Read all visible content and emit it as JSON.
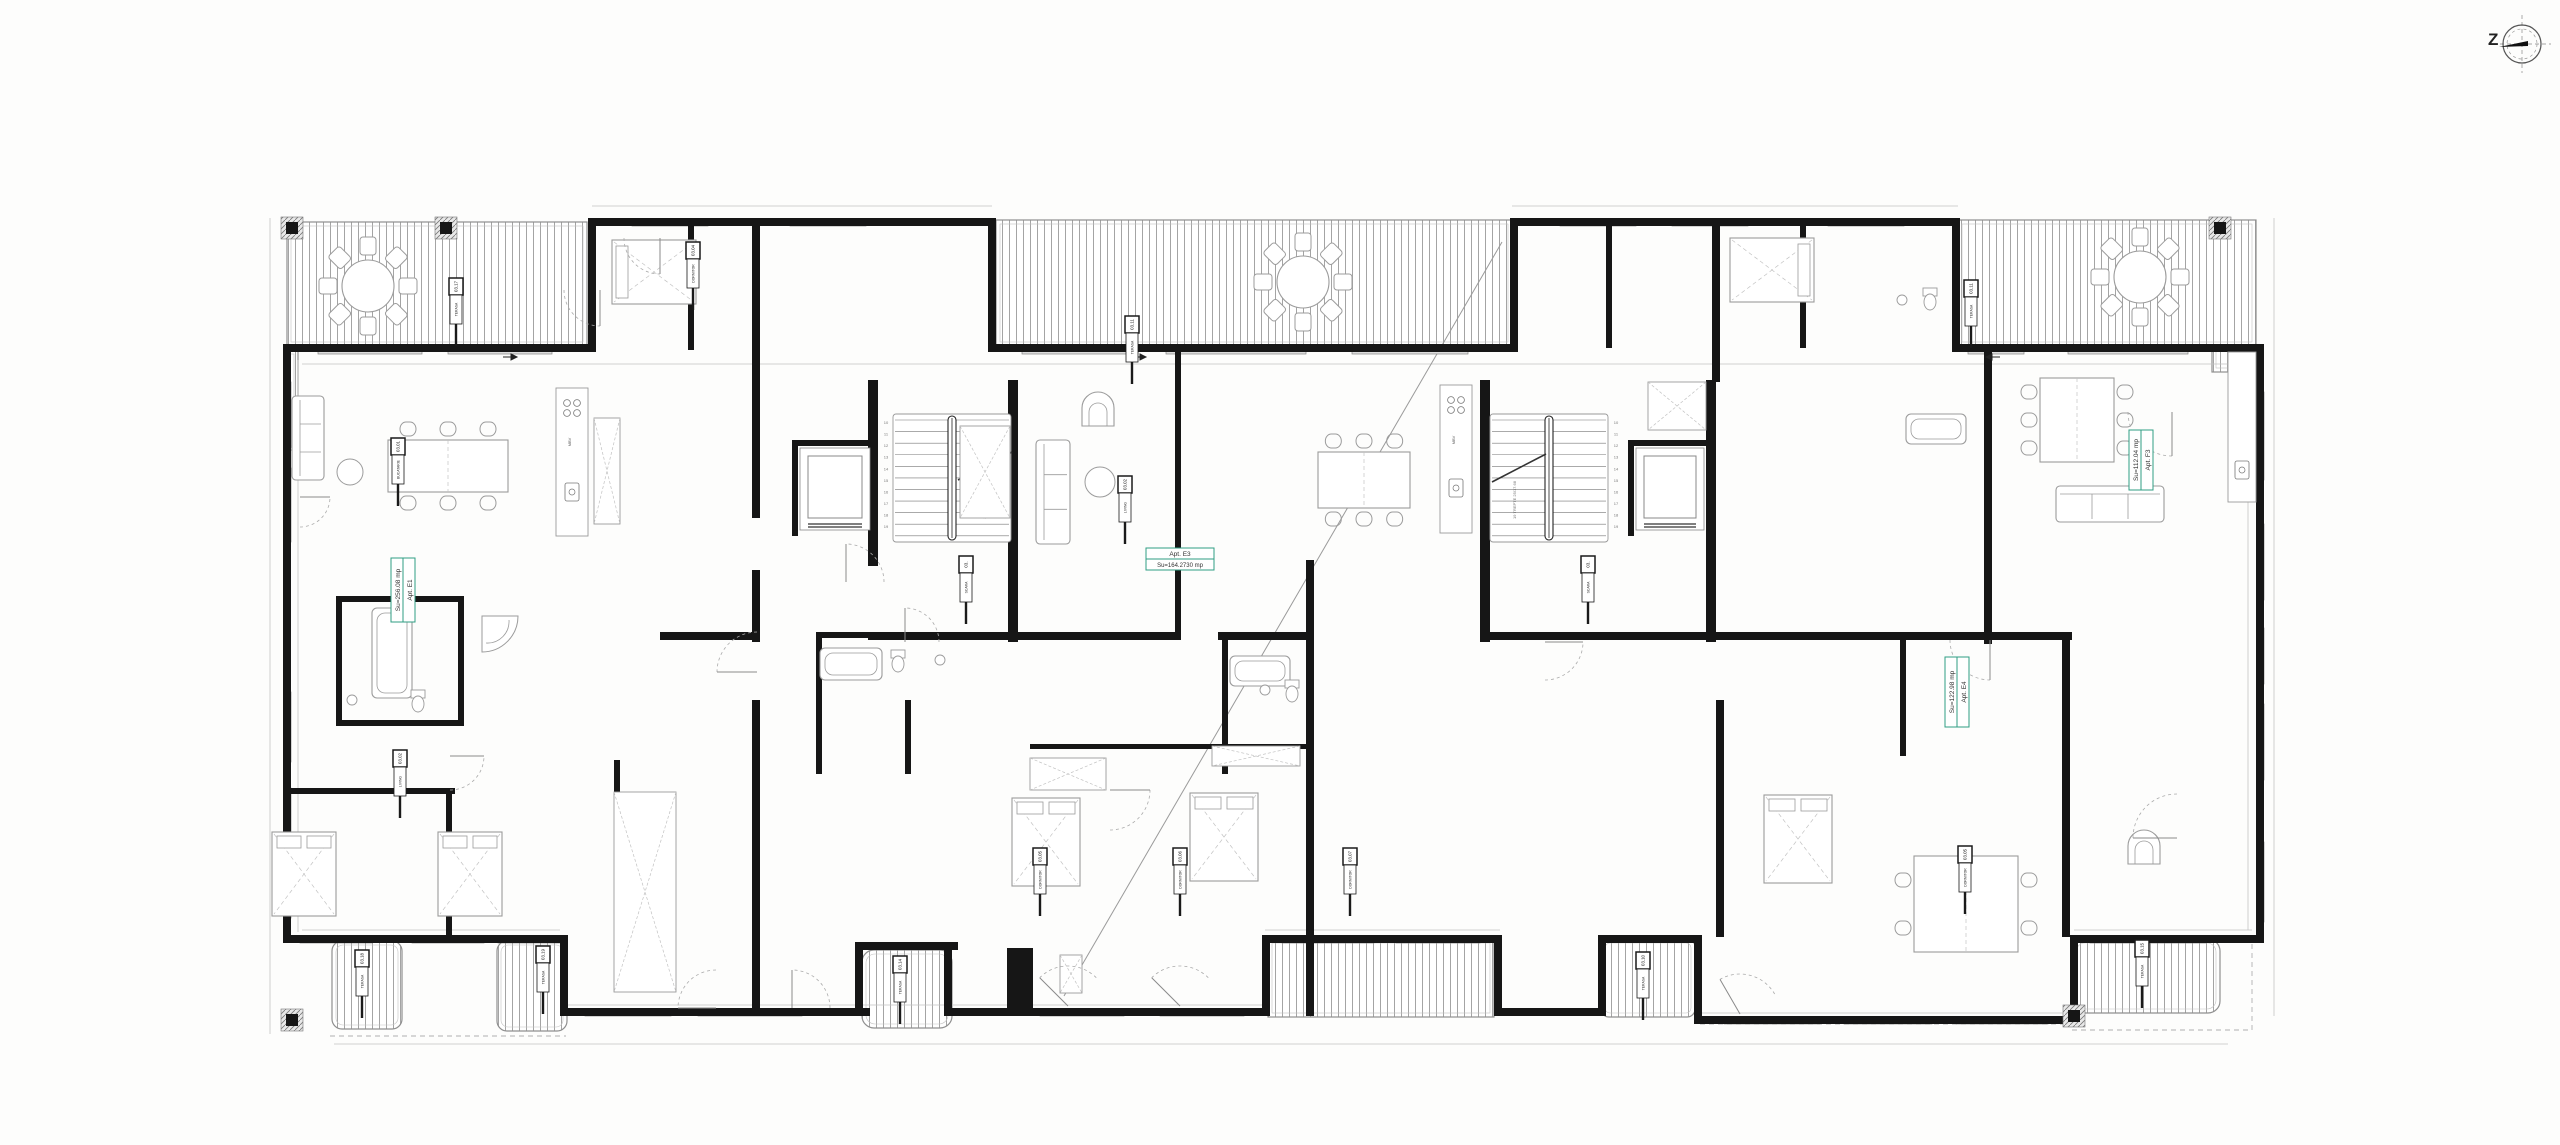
{
  "canvas": {
    "w": 2560,
    "h": 1145,
    "bg": "#fdfdfc"
  },
  "palette": {
    "wall": "#161616",
    "line": "#8f8f8f",
    "faint": "#c2c2c2",
    "furn": "#9b9b9b",
    "window": "#dcdcdc",
    "hatch": "#9a9a9a",
    "green": "#2f9e83",
    "tag": "#1a1a1a"
  },
  "compass": {
    "letter": "Z",
    "cx": 2522,
    "cy": 44,
    "r": 19
  },
  "apartment_labels": [
    {
      "id": "apt-e1",
      "line1": "Apt. E1",
      "line2": "Su=256.08 mp",
      "x": 391,
      "y": 622,
      "len": 64,
      "rot": true
    },
    {
      "id": "apt-e3",
      "line1": "Apt. E3",
      "line2": "Su=164.2730 mp",
      "x": 1146,
      "y": 548,
      "len": 68,
      "rot": false
    },
    {
      "id": "apt-e4",
      "line1": "Apt. E4",
      "line2": "Su=122.98 mp",
      "x": 1945,
      "y": 727,
      "len": 70,
      "rot": true
    },
    {
      "id": "apt-f3",
      "line1": "Apt. F3",
      "line2": "Su=112.04 mp",
      "x": 2129,
      "y": 490,
      "len": 60,
      "rot": true
    }
  ],
  "terraces": [
    {
      "x": 287,
      "y": 222,
      "w": 300,
      "h": 124,
      "rx": 0
    },
    {
      "x": 285,
      "y": 350,
      "w": 13,
      "h": 100,
      "rx": 0
    },
    {
      "x": 996,
      "y": 220,
      "w": 516,
      "h": 126,
      "rx": 0
    },
    {
      "x": 1958,
      "y": 220,
      "w": 298,
      "h": 126,
      "rx": 0
    },
    {
      "x": 2212,
      "y": 346,
      "w": 44,
      "h": 26,
      "rx": 0
    },
    {
      "x": 332,
      "y": 941,
      "w": 70,
      "h": 88,
      "rx": 10
    },
    {
      "x": 497,
      "y": 941,
      "w": 70,
      "h": 90,
      "rx": 10
    },
    {
      "x": 862,
      "y": 950,
      "w": 90,
      "h": 78,
      "rx": 12
    },
    {
      "x": 1268,
      "y": 939,
      "w": 226,
      "h": 78,
      "rx": 0
    },
    {
      "x": 1601,
      "y": 939,
      "w": 94,
      "h": 78,
      "rx": 8
    },
    {
      "x": 2072,
      "y": 939,
      "w": 148,
      "h": 74,
      "rx": 12
    }
  ],
  "walls": [
    [
      283,
      344,
      312,
      8
    ],
    [
      588,
      218,
      8,
      134
    ],
    [
      588,
      218,
      406,
      8
    ],
    [
      988,
      218,
      8,
      134
    ],
    [
      988,
      344,
      528,
      8
    ],
    [
      1510,
      218,
      8,
      134
    ],
    [
      1510,
      218,
      450,
      8
    ],
    [
      1952,
      218,
      8,
      134
    ],
    [
      1952,
      344,
      312,
      8
    ],
    [
      2256,
      344,
      8,
      599
    ],
    [
      283,
      344,
      8,
      599
    ],
    [
      283,
      935,
      283,
      8
    ],
    [
      560,
      935,
      8,
      80
    ],
    [
      560,
      1008,
      310,
      8
    ],
    [
      862,
      942,
      96,
      8
    ],
    [
      855,
      942,
      8,
      72
    ],
    [
      944,
      942,
      8,
      72
    ],
    [
      944,
      1008,
      326,
      8
    ],
    [
      1007,
      948,
      26,
      62
    ],
    [
      1262,
      935,
      8,
      80
    ],
    [
      1262,
      935,
      240,
      8
    ],
    [
      1494,
      935,
      8,
      80
    ],
    [
      1494,
      1008,
      112,
      8
    ],
    [
      1598,
      935,
      8,
      80
    ],
    [
      1598,
      935,
      104,
      8
    ],
    [
      1694,
      935,
      8,
      88
    ],
    [
      1694,
      1016,
      384,
      8
    ],
    [
      2070,
      935,
      8,
      88
    ],
    [
      2070,
      935,
      194,
      8
    ],
    [
      868,
      380,
      10,
      186
    ],
    [
      1008,
      380,
      10,
      262
    ],
    [
      868,
      632,
      150,
      8
    ],
    [
      792,
      440,
      84,
      6
    ],
    [
      792,
      440,
      6,
      96
    ],
    [
      1480,
      380,
      10,
      262
    ],
    [
      1706,
      380,
      10,
      262
    ],
    [
      1480,
      632,
      234,
      8
    ],
    [
      1628,
      440,
      84,
      6
    ],
    [
      1628,
      440,
      6,
      96
    ],
    [
      752,
      218,
      8,
      300
    ],
    [
      752,
      570,
      8,
      72
    ],
    [
      752,
      700,
      8,
      316
    ],
    [
      1175,
      352,
      6,
      288
    ],
    [
      1306,
      560,
      8,
      456
    ],
    [
      1712,
      218,
      8,
      164
    ],
    [
      1716,
      700,
      8,
      237
    ],
    [
      1984,
      352,
      8,
      292
    ],
    [
      2062,
      640,
      8,
      297
    ],
    [
      336,
      596,
      6,
      130
    ],
    [
      336,
      596,
      128,
      6
    ],
    [
      458,
      596,
      6,
      130
    ],
    [
      336,
      720,
      128,
      6
    ],
    [
      283,
      788,
      172,
      6
    ],
    [
      446,
      788,
      6,
      148
    ],
    [
      614,
      760,
      6,
      176
    ],
    [
      660,
      632,
      96,
      8
    ],
    [
      816,
      632,
      206,
      6
    ],
    [
      816,
      632,
      6,
      142
    ],
    [
      905,
      700,
      6,
      74
    ],
    [
      1018,
      632,
      162,
      8
    ],
    [
      1218,
      632,
      92,
      8
    ],
    [
      1222,
      638,
      6,
      136
    ],
    [
      1030,
      744,
      276,
      5
    ],
    [
      688,
      218,
      6,
      132
    ],
    [
      1606,
      218,
      6,
      130
    ],
    [
      1800,
      218,
      6,
      130
    ],
    [
      1716,
      632,
      272,
      8
    ],
    [
      1900,
      638,
      6,
      118
    ],
    [
      1986,
      632,
      86,
      8
    ]
  ],
  "windows_h": [
    {
      "x": 632,
      "y": 219,
      "w": 76
    },
    {
      "x": 790,
      "y": 219,
      "w": 76
    },
    {
      "x": 1560,
      "y": 219,
      "w": 76
    },
    {
      "x": 1672,
      "y": 219,
      "w": 76
    },
    {
      "x": 1828,
      "y": 219,
      "w": 76
    },
    {
      "x": 318,
      "y": 347,
      "w": 104
    },
    {
      "x": 448,
      "y": 347,
      "w": 104
    },
    {
      "x": 1022,
      "y": 347,
      "w": 116
    },
    {
      "x": 1166,
      "y": 347,
      "w": 140
    },
    {
      "x": 1352,
      "y": 347,
      "w": 116
    },
    {
      "x": 1968,
      "y": 347,
      "w": 56
    },
    {
      "x": 2068,
      "y": 347,
      "w": 120
    },
    {
      "x": 300,
      "y": 936,
      "w": 72
    },
    {
      "x": 412,
      "y": 936,
      "w": 72
    },
    {
      "x": 498,
      "y": 936,
      "w": 64
    },
    {
      "x": 1282,
      "y": 936,
      "w": 92
    },
    {
      "x": 1396,
      "y": 936,
      "w": 84
    },
    {
      "x": 2090,
      "y": 936,
      "w": 116
    },
    {
      "x": 585,
      "y": 1009,
      "w": 86
    },
    {
      "x": 698,
      "y": 1009,
      "w": 104
    },
    {
      "x": 1040,
      "y": 1009,
      "w": 84
    },
    {
      "x": 1160,
      "y": 1009,
      "w": 84
    },
    {
      "x": 1724,
      "y": 1017,
      "w": 96
    },
    {
      "x": 1844,
      "y": 1017,
      "w": 88
    },
    {
      "x": 1956,
      "y": 1017,
      "w": 92
    }
  ],
  "windows_v": [
    {
      "x": 284,
      "y": 382,
      "h": 66
    },
    {
      "x": 284,
      "y": 468,
      "h": 74
    },
    {
      "x": 284,
      "y": 692,
      "h": 70
    },
    {
      "x": 284,
      "y": 788,
      "h": 76
    },
    {
      "x": 284,
      "y": 858,
      "h": 60
    },
    {
      "x": 2257,
      "y": 392,
      "h": 88
    },
    {
      "x": 2257,
      "y": 524,
      "h": 76
    },
    {
      "x": 2257,
      "y": 628,
      "h": 56
    },
    {
      "x": 2257,
      "y": 704,
      "h": 76
    },
    {
      "x": 2257,
      "y": 842,
      "h": 80
    }
  ],
  "thin_lines": [
    [
      270,
      218,
      270,
      1034
    ],
    [
      2274,
      218,
      2274,
      1016
    ],
    [
      334,
      1044,
      2228,
      1044
    ],
    [
      592,
      206,
      992,
      206
    ],
    [
      1512,
      206,
      1958,
      206
    ],
    [
      298,
      360,
      298,
      932
    ],
    [
      2248,
      360,
      2248,
      930
    ],
    [
      302,
      364,
      2246,
      364
    ],
    [
      302,
      930,
      560,
      930
    ],
    [
      1265,
      930,
      1500,
      930
    ],
    [
      2074,
      930,
      2252,
      930
    ],
    [
      563,
      1005,
      1268,
      1005
    ],
    [
      1697,
      1013,
      2076,
      1013
    ]
  ],
  "dashed_lines": [
    [
      2252,
      935,
      2252,
      1030
    ],
    [
      2072,
      1030,
      2252,
      1030
    ],
    [
      330,
      1036,
      566,
      1036
    ],
    [
      1700,
      1024,
      2078,
      1024
    ]
  ],
  "leader_lines": [
    [
      1502,
      242,
      1064,
      996
    ]
  ],
  "stairs": [
    {
      "x": 893,
      "y": 414,
      "w": 118,
      "h": 128,
      "rail": 952,
      "numsX": 886,
      "labelX": 986,
      "labelY": 500,
      "break": [
        958,
        480,
        1012,
        452
      ]
    },
    {
      "x": 1490,
      "y": 414,
      "w": 118,
      "h": 128,
      "rail": 1549,
      "numsX": 1616,
      "labelX": 1516,
      "labelY": 500,
      "break": [
        1492,
        482,
        1546,
        454
      ]
    }
  ],
  "stair_numbers": [
    "10",
    "11",
    "12",
    "13",
    "14",
    "15",
    "16",
    "17",
    "18",
    "19"
  ],
  "stair_label": "19 TREPTE 25/17.68",
  "elevators": [
    {
      "x": 800,
      "y": 448,
      "w": 70,
      "h": 82
    },
    {
      "x": 1636,
      "y": 448,
      "w": 68,
      "h": 82
    }
  ],
  "columns": [
    [
      292,
      228
    ],
    [
      446,
      228
    ],
    [
      2220,
      228
    ],
    [
      2074,
      1016
    ],
    [
      292,
      1020
    ]
  ],
  "round_tables": [
    [
      368,
      286,
      26
    ],
    [
      1303,
      282,
      26
    ],
    [
      2140,
      277,
      26
    ]
  ],
  "dining_sets": [
    {
      "x": 388,
      "y": 440,
      "w": 120,
      "h": 52,
      "top": 3,
      "bottom": 3,
      "left": 0,
      "right": 0
    },
    {
      "x": 1318,
      "y": 452,
      "w": 92,
      "h": 56,
      "top": 3,
      "bottom": 3,
      "left": 0,
      "right": 0
    },
    {
      "x": 2040,
      "y": 378,
      "w": 74,
      "h": 84,
      "top": 0,
      "bottom": 0,
      "left": 3,
      "right": 3
    },
    {
      "x": 1914,
      "y": 856,
      "w": 104,
      "h": 96,
      "top": 0,
      "bottom": 0,
      "left": 2,
      "right": 2
    }
  ],
  "sofas": [
    {
      "x": 1036,
      "y": 440,
      "w": 34,
      "h": 104
    },
    {
      "x": 2056,
      "y": 486,
      "w": 108,
      "h": 36
    },
    {
      "x": 292,
      "y": 396,
      "w": 32,
      "h": 84
    }
  ],
  "armchairs": [
    [
      1098,
      412
    ],
    [
      2144,
      850
    ]
  ],
  "coffee_tables": [
    [
      1100,
      482,
      15
    ],
    [
      350,
      472,
      13
    ]
  ],
  "beds": [
    {
      "x": 612,
      "y": 240,
      "w": 84,
      "h": 64,
      "head": "w"
    },
    {
      "x": 1730,
      "y": 238,
      "w": 84,
      "h": 64,
      "head": "e"
    },
    {
      "x": 272,
      "y": 832,
      "w": 64,
      "h": 84,
      "head": "n"
    },
    {
      "x": 438,
      "y": 832,
      "w": 64,
      "h": 84,
      "head": "n"
    },
    {
      "x": 1012,
      "y": 798,
      "w": 68,
      "h": 88,
      "head": "n"
    },
    {
      "x": 1190,
      "y": 793,
      "w": 68,
      "h": 88,
      "head": "n"
    },
    {
      "x": 1764,
      "y": 795,
      "w": 68,
      "h": 88,
      "head": "n"
    }
  ],
  "wardrobes": [
    [
      594,
      418,
      26,
      106
    ],
    [
      614,
      792,
      62,
      200
    ],
    [
      1030,
      758,
      76,
      32
    ],
    [
      1212,
      746,
      88,
      20
    ],
    [
      1648,
      382,
      58,
      48
    ],
    [
      960,
      426,
      50,
      92
    ],
    [
      1060,
      955,
      22,
      38
    ]
  ],
  "tubs": [
    {
      "x": 372,
      "y": 608,
      "w": 40,
      "h": 90
    },
    {
      "x": 820,
      "y": 648,
      "w": 62,
      "h": 32
    },
    {
      "x": 1230,
      "y": 656,
      "w": 60,
      "h": 30
    },
    {
      "x": 1906,
      "y": 414,
      "w": 60,
      "h": 30
    }
  ],
  "showers": [
    [
      482,
      616,
      36
    ]
  ],
  "toilets": [
    [
      418,
      702
    ],
    [
      898,
      662
    ],
    [
      1292,
      692
    ],
    [
      1930,
      300
    ]
  ],
  "sinks": [
    [
      352,
      700
    ],
    [
      940,
      660
    ],
    [
      1265,
      690
    ],
    [
      1902,
      300
    ]
  ],
  "kitchens": [
    {
      "x": 556,
      "y": 388,
      "w": 32,
      "h": 148,
      "stove": [
        572,
        408
      ],
      "sink": [
        572,
        492
      ],
      "label": "MBV",
      "lx": 571,
      "ly": 442
    },
    {
      "x": 1440,
      "y": 385,
      "w": 32,
      "h": 148,
      "stove": [
        1456,
        405
      ],
      "sink": [
        1456,
        488
      ],
      "label": "MBV",
      "lx": 1455,
      "ly": 440
    },
    {
      "x": 2228,
      "y": 352,
      "w": 28,
      "h": 150,
      "stove": null,
      "sink": [
        2242,
        470
      ],
      "label": "",
      "lx": 0,
      "ly": 0
    }
  ],
  "doors": [
    {
      "cx": 300,
      "cy": 497,
      "r": 30,
      "a1": 270,
      "a2": 360
    },
    {
      "cx": 600,
      "cy": 290,
      "r": 36,
      "a1": 180,
      "a2": 270
    },
    {
      "cx": 846,
      "cy": 582,
      "r": 38,
      "a1": 0,
      "a2": 90
    },
    {
      "cx": 757,
      "cy": 672,
      "r": 40,
      "a1": 90,
      "a2": 180
    },
    {
      "cx": 1110,
      "cy": 790,
      "r": 40,
      "a1": 270,
      "a2": 360
    },
    {
      "cx": 2172,
      "cy": 412,
      "r": 44,
      "a1": 180,
      "a2": 270
    },
    {
      "cx": 2177,
      "cy": 838,
      "r": 44,
      "a1": 90,
      "a2": 180
    },
    {
      "cx": 1545,
      "cy": 642,
      "r": 38,
      "a1": 270,
      "a2": 360
    },
    {
      "cx": 660,
      "cy": 238,
      "r": 36,
      "a1": 180,
      "a2": 270
    },
    {
      "cx": 1068,
      "cy": 1006,
      "r": 40,
      "a1": 45,
      "a2": 135
    },
    {
      "cx": 1180,
      "cy": 1006,
      "r": 40,
      "a1": 45,
      "a2": 135
    },
    {
      "cx": 1740,
      "cy": 1014,
      "r": 40,
      "a1": 30,
      "a2": 120
    },
    {
      "cx": 450,
      "cy": 756,
      "r": 34,
      "a1": 270,
      "a2": 360
    },
    {
      "cx": 1990,
      "cy": 640,
      "r": 40,
      "a1": 180,
      "a2": 270
    },
    {
      "cx": 905,
      "cy": 642,
      "r": 34,
      "a1": 0,
      "a2": 90
    },
    {
      "cx": 716,
      "cy": 1008,
      "r": 38,
      "a1": 90,
      "a2": 180
    },
    {
      "cx": 792,
      "cy": 1008,
      "r": 38,
      "a1": 0,
      "a2": 90
    }
  ],
  "arrows": [
    [
      513,
      357,
      -1
    ],
    [
      1142,
      357,
      -1
    ],
    [
      1990,
      357,
      1
    ]
  ],
  "room_tags": [
    {
      "x": 456,
      "y": 278,
      "num": "03.17",
      "name": "TERASA"
    },
    {
      "x": 1132,
      "y": 316,
      "num": "03.11",
      "name": "TERASA"
    },
    {
      "x": 1971,
      "y": 280,
      "num": "03.11",
      "name": "TERASA"
    },
    {
      "x": 398,
      "y": 438,
      "num": "03.01",
      "name": "BUCATARIE"
    },
    {
      "x": 400,
      "y": 750,
      "num": "03.02",
      "name": "LIVING"
    },
    {
      "x": 362,
      "y": 950,
      "num": "03.18",
      "name": "TERASA"
    },
    {
      "x": 543,
      "y": 946,
      "num": "03.19",
      "name": "TERASA"
    },
    {
      "x": 900,
      "y": 956,
      "num": "03.14",
      "name": "TERASA"
    },
    {
      "x": 1643,
      "y": 952,
      "num": "03.10",
      "name": "TERASA"
    },
    {
      "x": 2142,
      "y": 940,
      "num": "03.15",
      "name": "TERASA"
    },
    {
      "x": 966,
      "y": 556,
      "num": "03.",
      "name": "SCARA"
    },
    {
      "x": 1588,
      "y": 556,
      "num": "03.",
      "name": "SCARA"
    },
    {
      "x": 1040,
      "y": 848,
      "num": "03.05",
      "name": "DORMITOR"
    },
    {
      "x": 1180,
      "y": 848,
      "num": "03.06",
      "name": "DORMITOR"
    },
    {
      "x": 1350,
      "y": 848,
      "num": "03.07",
      "name": "DORMITOR"
    },
    {
      "x": 1965,
      "y": 846,
      "num": "03.05",
      "name": "DORMITOR"
    },
    {
      "x": 1125,
      "y": 476,
      "num": "03.02",
      "name": "LIVING"
    },
    {
      "x": 693,
      "y": 242,
      "num": "03.04",
      "name": "DORMITOR"
    }
  ]
}
